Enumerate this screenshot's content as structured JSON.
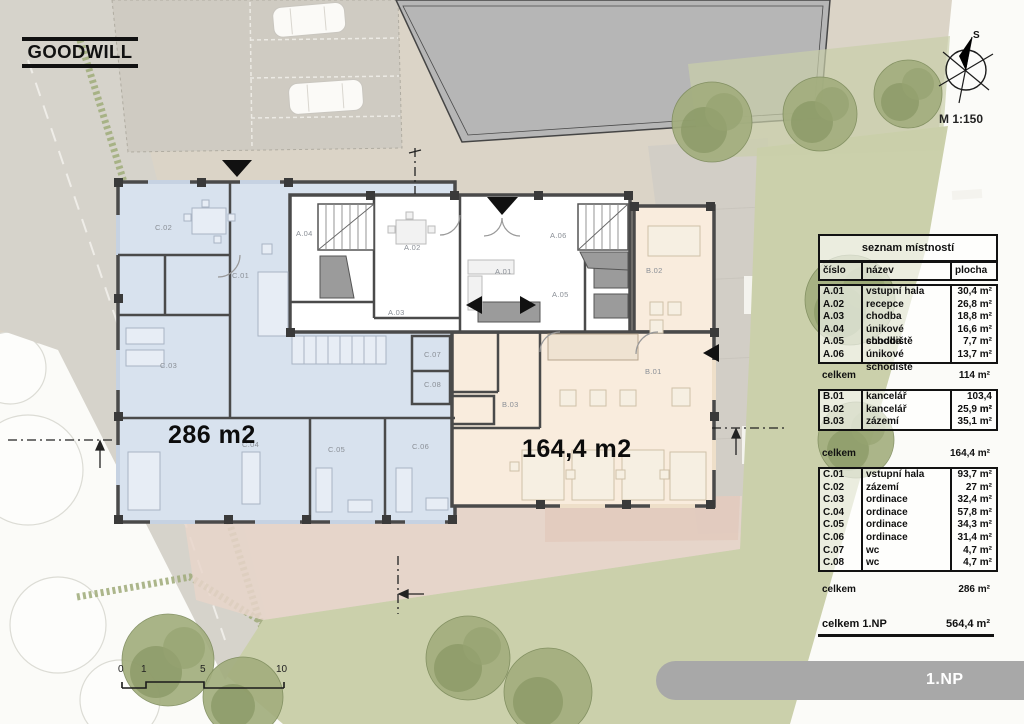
{
  "logo": {
    "text": "GOODWILL"
  },
  "compass": {
    "north_label": "S",
    "scale_label": "M 1:150"
  },
  "plan": {
    "area_labels": {
      "left": "286 m2",
      "right": "164,4 m2"
    },
    "room_labels": {
      "a01": "A.01",
      "a02": "A.02",
      "a03": "A.03",
      "a04": "A.04",
      "a05": "A.05",
      "a06": "A.06",
      "b01": "B.01",
      "b02": "B.02",
      "b03": "B.03",
      "c01": "C.01",
      "c02": "C.02",
      "c03": "C.03",
      "c04": "C.04",
      "c05": "C.05",
      "c06": "C.06",
      "c07": "C.07",
      "c08": "C.08"
    }
  },
  "legend": {
    "title": "seznam místností",
    "columns": {
      "number": "číslo",
      "name": "název",
      "area": "plocha"
    },
    "sections": [
      {
        "rows": [
          {
            "number": "A.01",
            "name": "vstupní hala",
            "area": "30,4 m²"
          },
          {
            "number": "A.02",
            "name": "recepce",
            "area": "26,8 m²"
          },
          {
            "number": "A.03",
            "name": "chodba",
            "area": "18,8 m²"
          },
          {
            "number": "A.04",
            "name": "únikové schodiště",
            "area": "16,6 m²"
          },
          {
            "number": "A.05",
            "name": "chodba",
            "area": "7,7 m²"
          },
          {
            "number": "A.06",
            "name": "únikové schodiště",
            "area": "13,7 m²"
          }
        ],
        "total_label": "celkem",
        "total_value": "114 m²"
      },
      {
        "rows": [
          {
            "number": "B.01",
            "name": "kancelář",
            "area": "103,4 m²"
          },
          {
            "number": "B.02",
            "name": "kancelář",
            "area": "25,9 m²"
          },
          {
            "number": "B.03",
            "name": "zázemí",
            "area": "35,1 m²"
          }
        ],
        "total_label": "celkem",
        "total_value": "164,4 m²"
      },
      {
        "rows": [
          {
            "number": "C.01",
            "name": "vstupní hala",
            "area": "93,7 m²"
          },
          {
            "number": "C.02",
            "name": "zázemí",
            "area": "27 m²"
          },
          {
            "number": "C.03",
            "name": "ordinace",
            "area": "32,4 m²"
          },
          {
            "number": "C.04",
            "name": "ordinace",
            "area": "57,8 m²"
          },
          {
            "number": "C.05",
            "name": "ordinace",
            "area": "34,3 m²"
          },
          {
            "number": "C.06",
            "name": "ordinace",
            "area": "31,4 m²"
          },
          {
            "number": "C.07",
            "name": "wc",
            "area": "4,7 m²"
          },
          {
            "number": "C.08",
            "name": "wc",
            "area": "4,7 m²"
          }
        ],
        "total_label": "celkem",
        "total_value": "286 m²"
      }
    ],
    "grand_total": {
      "label": "celkem 1.NP",
      "value": "564,4 m²"
    }
  },
  "scalebar": {
    "ticks": [
      "0",
      "1",
      "5",
      "10"
    ]
  },
  "floor_tab": {
    "label": "1.NP"
  },
  "colors": {
    "zone_c_blue": "#d8e2ee",
    "zone_b_orange": "#f9ecdd",
    "zone_a_white": "#ffffff",
    "wall": "#4a4a4a",
    "site_beige": "#dbd4c7",
    "lawn_green": "#cbd0ab",
    "existing_building_gray": "#b5b5b5",
    "floor_tab_gray": "#a8a8a8"
  }
}
